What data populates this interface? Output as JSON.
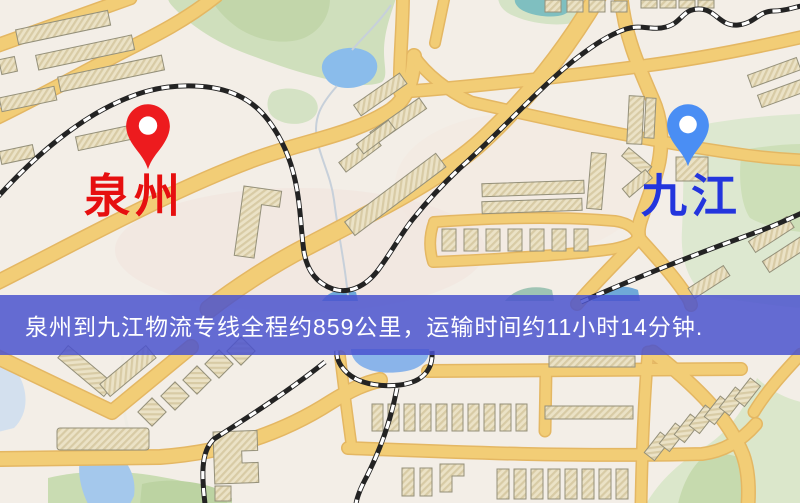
{
  "page": {
    "width": 800,
    "height": 503
  },
  "map": {
    "kind": "logistics-route-map",
    "origin": {
      "label": "泉州",
      "pin": "red-map-pin",
      "pin_color": "#ed1b1e",
      "label_color": "#e60f0f"
    },
    "destination": {
      "label": "九江",
      "pin": "blue-map-pin",
      "pin_color": "#4a8ef4",
      "label_color": "#2335dd"
    },
    "banner": {
      "text": "泉州到九江物流专线全程约859公里，运输时间约11小时14分钟.",
      "background_color": "#4951ce",
      "text_color": "#ffffff",
      "distance_km": "859",
      "duration": "11小时14分钟"
    },
    "legend_colors": {
      "land": "#f3eee7",
      "road": "#f2cd76",
      "road_edge": "#e4b763",
      "park": "#cfdfbc",
      "water": "#8abceb",
      "building": "#ebe2c6",
      "railway": "#232323"
    }
  }
}
